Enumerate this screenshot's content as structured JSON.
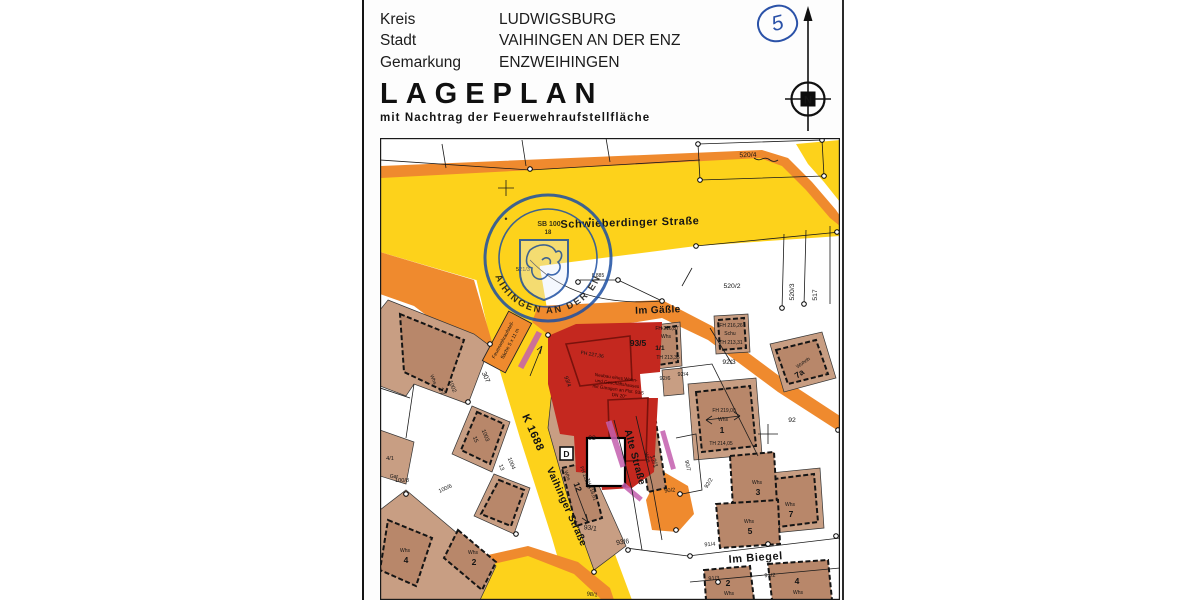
{
  "header": {
    "rows": [
      {
        "label": "Kreis",
        "value": "LUDWIGSBURG"
      },
      {
        "label": "Stadt",
        "value": "VAIHINGEN AN DER ENZ"
      },
      {
        "label": "Gemarkung",
        "value": "ENZWEIHINGEN"
      }
    ],
    "title": "LAGEPLAN",
    "subtitle": "mit Nachtrag der Feuerwehraufstellfläche",
    "sheet_number": "5",
    "north_letter": "N"
  },
  "stamp": {
    "ring_text": "VAIHINGEN AN DER ENZ",
    "line1": "SB 100",
    "line2": "18"
  },
  "map": {
    "streets": [
      {
        "name": "Schwieberdinger Straße"
      },
      {
        "name": "Im Gäßle"
      },
      {
        "name": "K 1688"
      },
      {
        "name": "Vaihinger Straße"
      },
      {
        "name": "Alte Straße"
      },
      {
        "name": "Im Biegel"
      }
    ],
    "parcels": [
      "520/4",
      "520/2",
      "520/3",
      "517",
      "521/3",
      "307",
      "93/4",
      "93",
      "93/1",
      "93/6",
      "12/1",
      "90/2",
      "90/7",
      "92/2",
      "92/6",
      "92/4",
      "92/3",
      "92",
      "91/4",
      "91/3",
      "91/2",
      "98/1",
      "17",
      "1002",
      "15",
      "1003",
      "13",
      "1004",
      "100/6",
      "100/8",
      "4/1",
      "Gar",
      "1/1"
    ],
    "buildings": [
      {
        "fh": "FH 216,87",
        "use": "Whs",
        "th": "TH 213,35"
      },
      {
        "fh": "FH 216,26",
        "use": "Schu",
        "th": "TH 213,31"
      },
      {
        "fh": "FH 219,00",
        "use": "Whs",
        "no": "1",
        "th": "TH 214,05"
      },
      {
        "use": "Wohnh",
        "no": "7a"
      },
      {
        "use": "Whs",
        "no": "7"
      },
      {
        "use": "Whs",
        "no": "3"
      },
      {
        "use": "Whs",
        "no": "5"
      },
      {
        "use": "Whs",
        "no": "2"
      },
      {
        "use": "Whs",
        "no": "4"
      },
      {
        "use": "Whs",
        "no": "12",
        "fh": "FH 222,19",
        "th": "TH 218,61"
      },
      {
        "use": "Whs",
        "no": "2"
      },
      {
        "use": "Whs",
        "no": "4"
      },
      {
        "use": "Whs"
      },
      {
        "no": "D"
      },
      {
        "use": "Whs"
      }
    ],
    "subject": {
      "parcel": "93/5",
      "fh": "FH 227,36",
      "note_lines": [
        "Neubau eines Wohn-",
        "und Geschäftshauses",
        "mit Garagen an Flst. 93/5",
        "DN 20°"
      ]
    },
    "firetruck_area": {
      "line1": "Feuerwehraufstell-",
      "line2": "fläche 5 x 11 m"
    },
    "dimension": "8,885"
  },
  "colors": {
    "road_yellow": "#fdd21b",
    "road_orange": "#ef8a2e",
    "subject_red": "#c4281f",
    "parcel_tan": "#c89e83",
    "building_tan": "#b8876a",
    "stamp_blue": "#1d4fa3",
    "hatch_magenta": "#c45fae"
  }
}
